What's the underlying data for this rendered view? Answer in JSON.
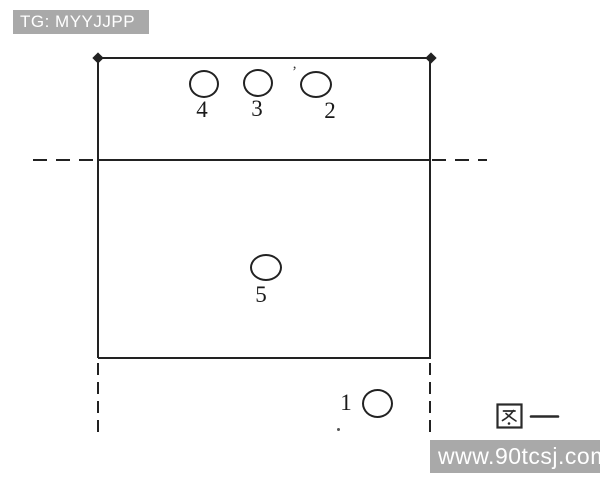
{
  "colors": {
    "line": "#222222",
    "bg": "#ffffff",
    "wm_bg": "#a9a9a9",
    "wm_text": "#ffffff"
  },
  "watermarks": {
    "top_badge": {
      "text": "TG: MYYJJPP"
    },
    "bottom_badge": {
      "text": "www.90tcsj.com"
    }
  },
  "figure": {
    "caption": "图一"
  },
  "court": {
    "players": [
      {
        "number": "4"
      },
      {
        "number": "3"
      },
      {
        "number": "2"
      },
      {
        "number": "5"
      },
      {
        "number": "1"
      }
    ]
  }
}
